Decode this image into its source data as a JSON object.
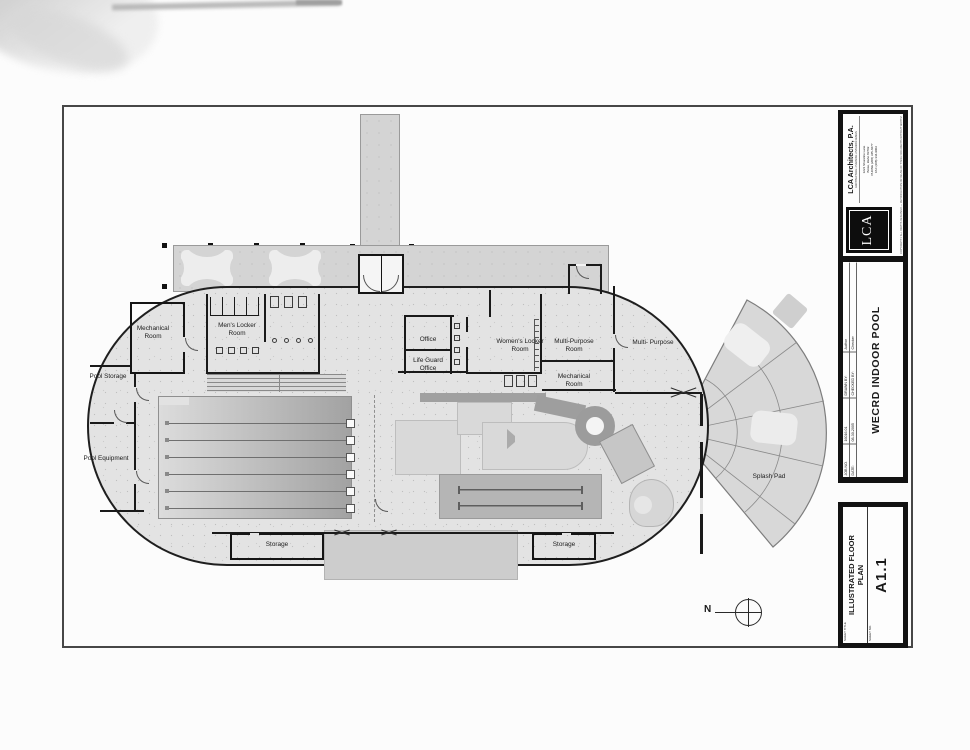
{
  "titleblock": {
    "firm_name": "LCA Architects, P.A.",
    "firm_tagline": "ARCHITECTURE • PLANNING • INTERIOR DESIGN",
    "address": "1221 Shoreline Lane\nBoise, Idaho 83702\nPHONE (208) 345-6677\nFAX (208) 344-9002",
    "logo_text": "LCA",
    "copyright": "COPYRIGHT © ALL RIGHTS RESERVED — REPRODUCTION OR REUSE OF THESE DOCUMENTS WITHOUT WRITTEN CONSENT OF LCA ARCHITECTS P.A. IS PROHIBITED",
    "job_no_label": "JOB NO.",
    "job_no": "16016.01",
    "date_label": "DATE:",
    "date": "08-30-2005",
    "drawn_by_label": "DRAWN BY:",
    "drawn_by": "Author",
    "checked_by_label": "CHECKED BY:",
    "checked_by": "Checker",
    "project_name": "WECRD INDOOR POOL",
    "sheet_title_label": "SHEET TITLE",
    "sheet_title": "ILLUSTRATED FLOOR\nPLAN",
    "sheet_no_label": "SHEET NO.",
    "sheet_no": "A1.1"
  },
  "plan": {
    "north_label": "N",
    "rooms": [
      {
        "id": "mechanical-room-west",
        "label": "Mechanical\nRoom"
      },
      {
        "id": "pool-storage",
        "label": "Pool Storage"
      },
      {
        "id": "pool-equipment",
        "label": "Pool Equipment"
      },
      {
        "id": "mens-locker-room",
        "label": "Men's Locker\nRoom"
      },
      {
        "id": "office",
        "label": "Office"
      },
      {
        "id": "life-guard-office",
        "label": "Life Guard\nOffice"
      },
      {
        "id": "womens-locker-room",
        "label": "Women's Locker\nRoom"
      },
      {
        "id": "multi-purpose-room",
        "label": "Multi-Purpose\nRoom"
      },
      {
        "id": "mechanical-room-east",
        "label": "Mechanical\nRoom"
      },
      {
        "id": "multi-purpose-hall",
        "label": "Multi- Purpose"
      },
      {
        "id": "splash-pad",
        "label": "Splash Pad"
      },
      {
        "id": "storage-west",
        "label": "Storage"
      },
      {
        "id": "storage-east",
        "label": "Storage"
      }
    ]
  },
  "colors": {
    "paper": "#fcfcfc",
    "ink": "#1a1a1a",
    "concrete": "#e3e3e3",
    "water": "#d9d9d9"
  }
}
